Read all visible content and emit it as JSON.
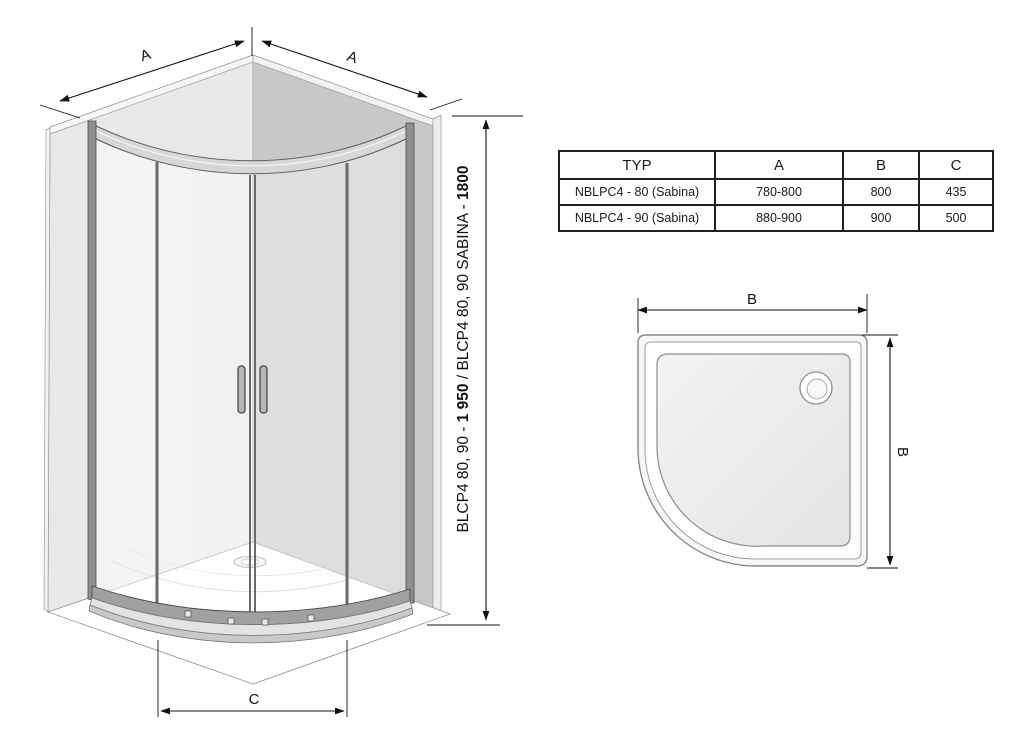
{
  "iso_view": {
    "dim_a_left_label": "A",
    "dim_a_right_label": "A",
    "dim_c_label": "C",
    "height_label_parts": {
      "p1": "BLCP4 80, 90 - ",
      "p2_bold": "1 950",
      "p3": " / BLCP4 80, 90 SABINA - ",
      "p4_bold": "1800"
    }
  },
  "spec_table": {
    "headers": {
      "typ": "TYP",
      "a": "A",
      "b": "B",
      "c": "C"
    },
    "rows": [
      {
        "typ": "NBLPC4 - 80 (Sabina)",
        "a": "780-800",
        "b": "800",
        "c": "435"
      },
      {
        "typ": "NBLPC4 - 90 (Sabina)",
        "a": "880-900",
        "b": "900",
        "c": "500"
      }
    ]
  },
  "top_view": {
    "dim_b_width_label": "B",
    "dim_b_depth_label": "B"
  },
  "colors": {
    "line": "#1a1a1a",
    "wall_left": "#e7e8e8",
    "wall_right": "#c7c9c9",
    "frame": "#6a6a6a",
    "tray_basin": "#ececec"
  }
}
